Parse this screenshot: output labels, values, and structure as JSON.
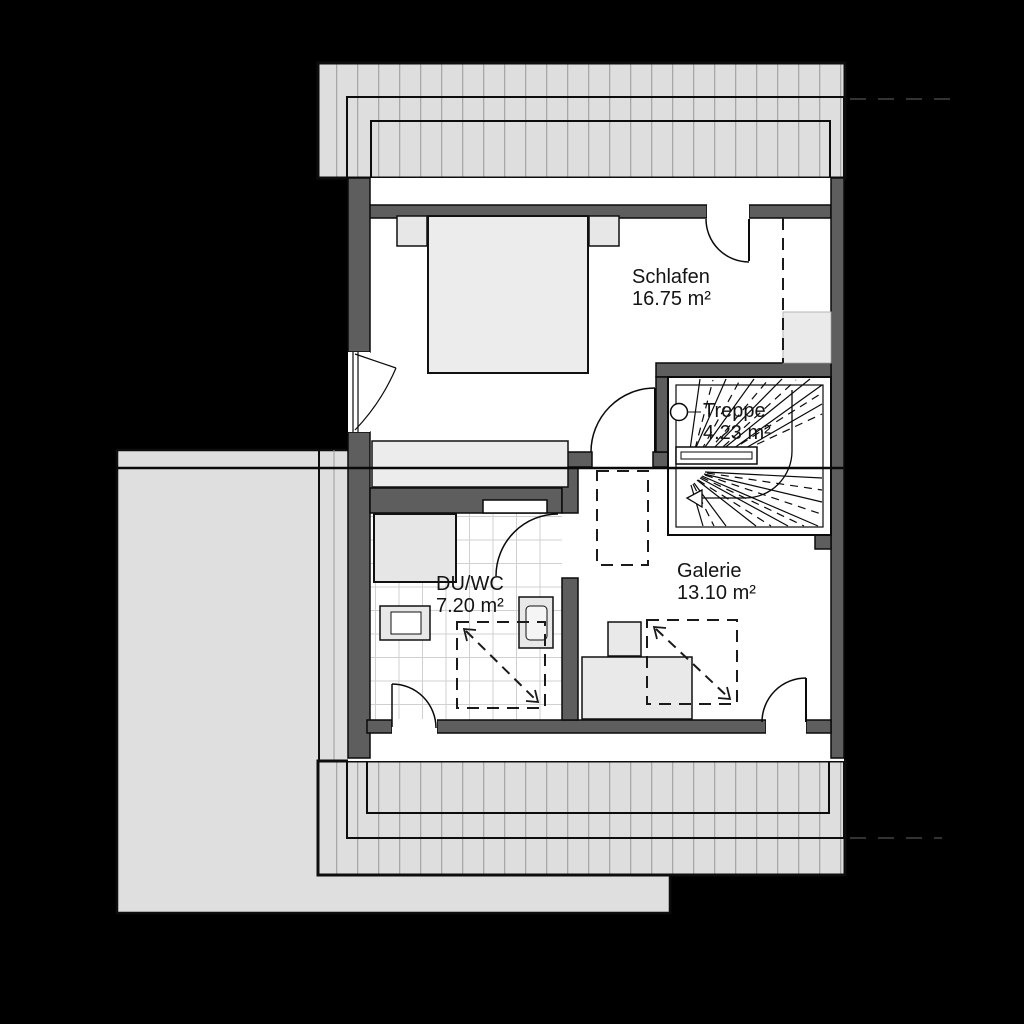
{
  "plan": {
    "type": "floor-plan",
    "floor": "upper-floor"
  },
  "rooms": [
    {
      "name": "Schlafen",
      "area": "16.75 m²"
    },
    {
      "name": "Treppe",
      "area": "4.23 m²"
    },
    {
      "name": "DU/WC",
      "area": "7.20 m²"
    },
    {
      "name": "Galerie",
      "area": "13.10 m²"
    }
  ],
  "colors": {
    "background": "#000000",
    "wall": "#5e5e5e",
    "roof_hatch": "#dedede",
    "hatch_line": "#a8a8a8",
    "terrace": "#dfdfdf",
    "furniture": "#ececec",
    "floor": "#ffffff",
    "tile_line": "#d0d0d0",
    "line": "#0a0a0a",
    "text": "#141414"
  }
}
